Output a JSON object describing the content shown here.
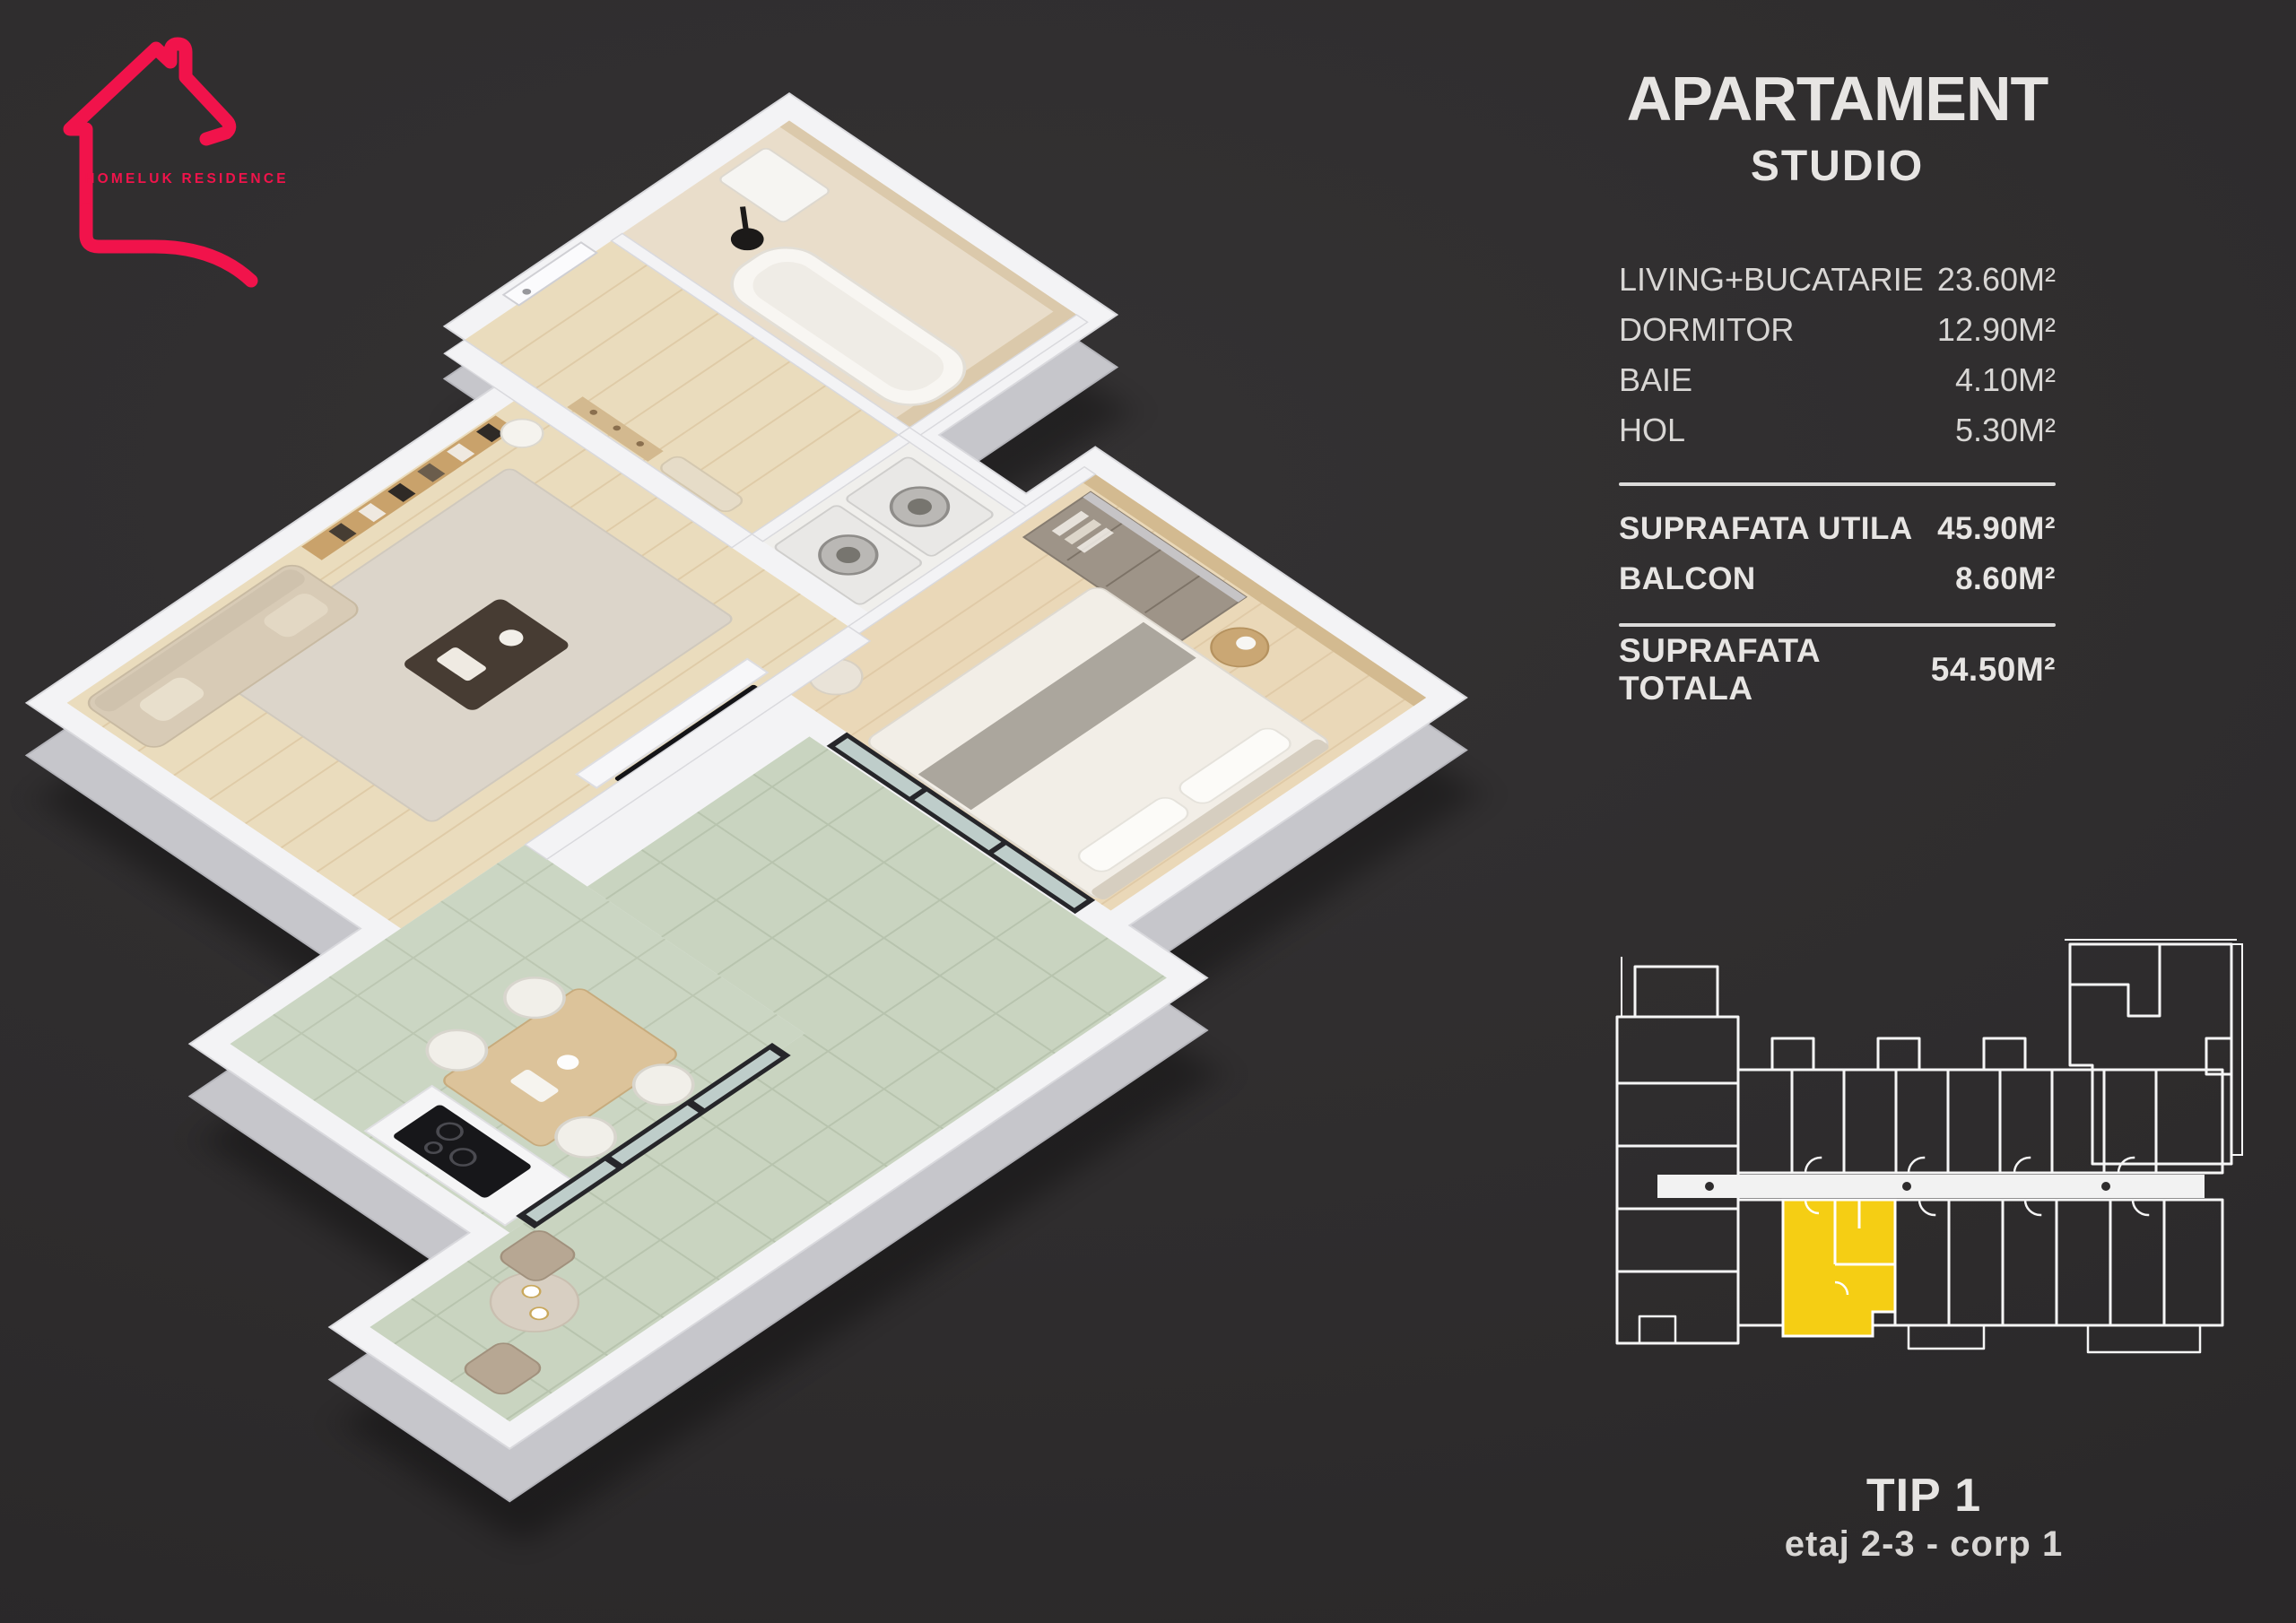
{
  "brand": {
    "name": "HOMELUK RESIDENCE"
  },
  "header": {
    "title": "APARTAMENT",
    "subtitle": "STUDIO"
  },
  "areas": {
    "rooms": [
      {
        "label": "LIVING+BUCATARIE",
        "value": "23.60M²"
      },
      {
        "label": "DORMITOR",
        "value": "12.90M²"
      },
      {
        "label": "BAIE",
        "value": "4.10M²"
      },
      {
        "label": "HOL",
        "value": "5.30M²"
      }
    ],
    "summary": [
      {
        "label": "SUPRAFATA UTILA",
        "value": "45.90M²"
      },
      {
        "label": "BALCON",
        "value": "8.60M²"
      }
    ],
    "total": {
      "label": "SUPRAFATA TOTALA",
      "value": "54.50M²"
    }
  },
  "unit": {
    "type": "TIP 1",
    "location": "etaj 2-3 - corp 1"
  },
  "colors": {
    "bg": "#2e2c2d",
    "accent_red": "#f1134b",
    "accent_yellow": "#f5ce14",
    "text_primary": "#e7e5e3",
    "text_secondary": "#d8d6d4",
    "divider": "#dcdbda",
    "wall": "#f3f3f5",
    "wall_side": "#c6c6cb",
    "wood": "#eadcbd",
    "tile": "#cbd6c3"
  }
}
